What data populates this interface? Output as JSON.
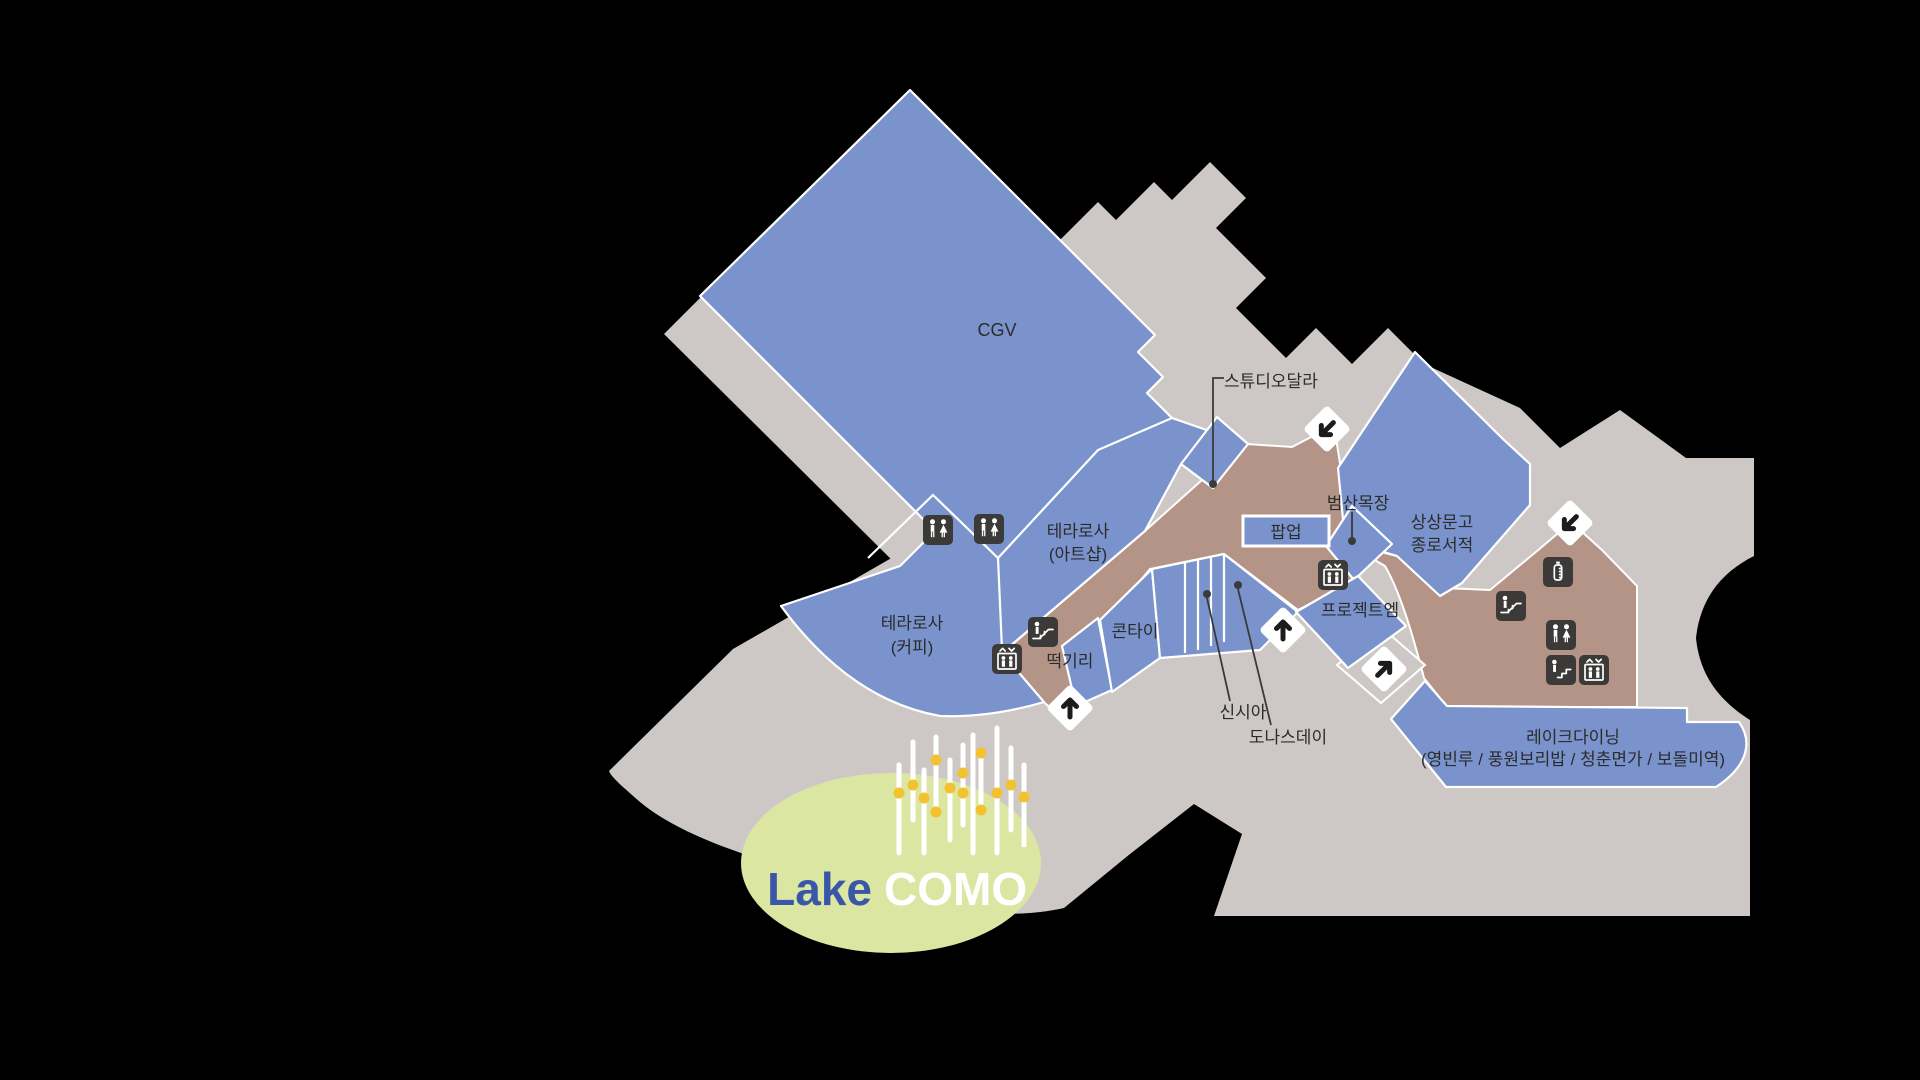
{
  "map": {
    "title": "mall-floor-plan",
    "areas": {
      "cgv": {
        "label": "CGV"
      },
      "terarosa_artshop": {
        "line1": "테라로사",
        "line2": "(아트샵)"
      },
      "terarosa_coffee": {
        "line1": "테라로사",
        "line2": "(커피)"
      },
      "kontai": {
        "label": "콘타이"
      },
      "tteokgiri": {
        "label": "떡기리"
      },
      "popup": {
        "label": "팝업"
      },
      "beomsan": {
        "label": "범산목장"
      },
      "sangsang": {
        "line1": "상상문고",
        "line2": "종로서적"
      },
      "projectm": {
        "label": "프로젝트엠"
      },
      "lakedining": {
        "line1": "레이크다이닝",
        "line2": "(영빈루 / 풍원보리밥 / 청춘면가 / 보돌미역)"
      },
      "studio_dala": {
        "label": "스튜디오달라"
      },
      "sinsia": {
        "label": "신시아"
      },
      "donasday": {
        "label": "도나스데이"
      }
    },
    "logo": {
      "lake": "Lake",
      "como": "COMO"
    },
    "icons": {
      "restroom": "restroom-icon",
      "elevator": "elevator-icon",
      "escalator": "escalator-icon",
      "stairs": "stairs-icon",
      "nursing_room": "nursing-room-icon",
      "direction_arrow": "direction-arrow-icon"
    },
    "colors": {
      "background": "#000000",
      "floor_gray": "#cdc8c6",
      "store_blue": "#7b93cc",
      "corridor_brown": "#b39486",
      "icon_tile": "#3b3a38",
      "outline_white": "#ffffff",
      "logo_ellipse_green": "#dce6a3",
      "logo_lake_blue": "#3a57a7",
      "logo_como_white": "#ffffff",
      "fountain_dot_yellow": "#f2c230",
      "label_dark": "#2b2b2b"
    }
  }
}
